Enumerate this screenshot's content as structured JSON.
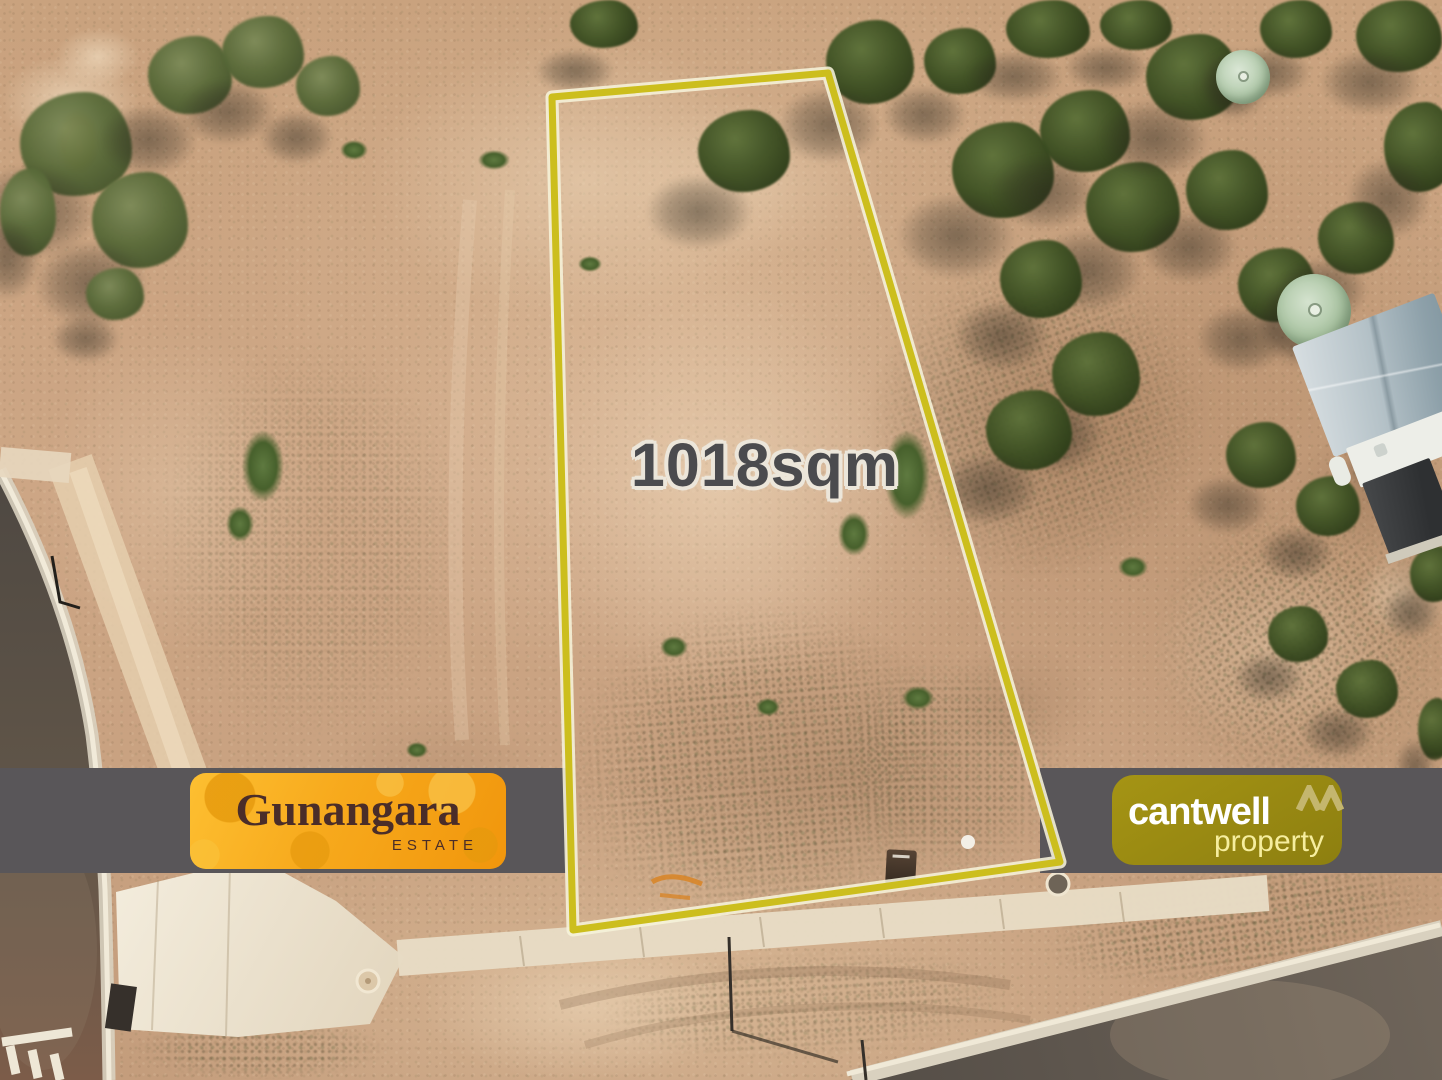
{
  "overlay": {
    "area_label": "1018sqm",
    "boundary_color": "#ccbe1d",
    "label_color": "#4b4b4e"
  },
  "banner": {
    "background_color": "#595659",
    "estate_logo": {
      "name": "Gunangara",
      "subtitle": "ESTATE",
      "background_from": "#fdbf31",
      "background_to": "#f1960c",
      "text_color": "#4a2d29"
    },
    "agency_logo": {
      "name": "cantwell",
      "subtitle": "property",
      "mark": "double-peak-M",
      "background": "#9c8d13",
      "name_color": "#ffffff",
      "subtitle_color": "#f6ee9e",
      "mark_color": "#c4b66e"
    }
  },
  "scene": {
    "ground_color": "#c9a27f",
    "road_color": "#4e4842",
    "concrete_color": "#eee4cf",
    "tree_color": "#3f5224"
  }
}
